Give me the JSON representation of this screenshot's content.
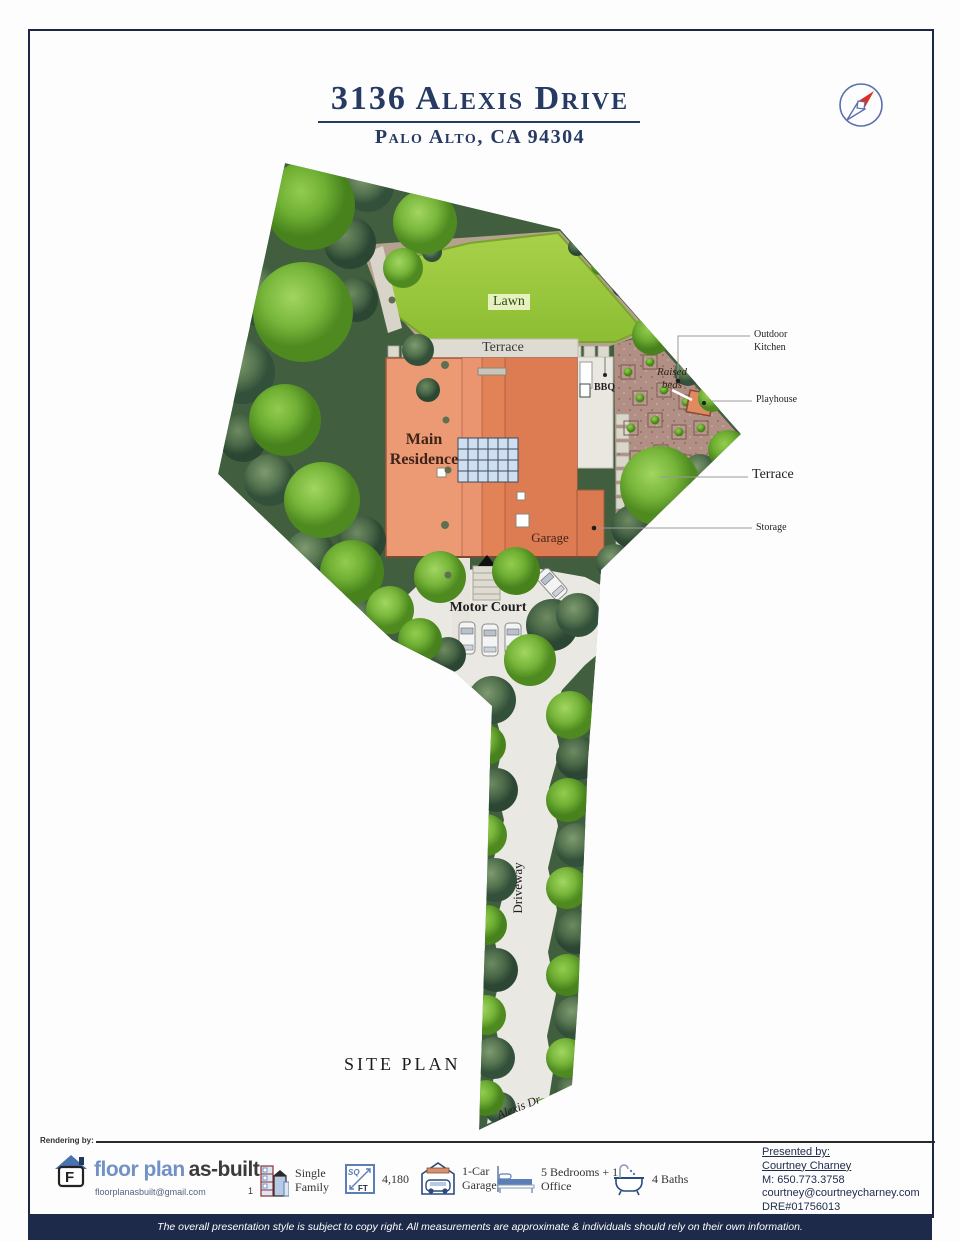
{
  "header": {
    "title": "3136 Alexis Drive",
    "subtitle": "Palo Alto, CA 94304"
  },
  "plan": {
    "site_plan_title": "SITE PLAN",
    "labels": {
      "lawn": "Lawn",
      "terrace_top": "Terrace",
      "main_residence": "Main Residence",
      "garage": "Garage",
      "bbq": "BBQ",
      "raised_beds": "Raised beds",
      "motor_court": "Motor Court",
      "driveway": "Driveway",
      "alexis_dr": "Alexis Dr",
      "outdoor_kitchen": "Outdoor Kitchen",
      "playhouse": "Playhouse",
      "terrace_right": "Terrace",
      "storage": "Storage"
    }
  },
  "footer": {
    "rendering_by": "Rendering by:",
    "logo": {
      "brand_blue": "floor plan",
      "brand_dark": "as-built",
      "letter": "F",
      "email": "floorplanasbuilt@gmail.com"
    },
    "stats": [
      {
        "icon": "building-icon",
        "prefix": "1",
        "label": "Single Family"
      },
      {
        "icon": "sqft-icon",
        "sq": "SQ",
        "ft": "FT",
        "label": "4,180"
      },
      {
        "icon": "garage-icon",
        "label": "1-Car Garage"
      },
      {
        "icon": "bed-icon",
        "label": "5 Bedrooms + 1 Office"
      },
      {
        "icon": "bath-icon",
        "label": "4 Baths"
      }
    ],
    "presented": {
      "heading": "Presented by:",
      "name": "Courtney Charney",
      "mobile": "M: 650.773.3758",
      "email": "courtney@courtneycharney.com",
      "dre": "DRE#01756013"
    },
    "disclaimer": "The overall presentation style is subject to copy right. All measurements are approximate & individuals should rely on their own information."
  },
  "colors": {
    "navy": "#1e2a4a",
    "house_orange": "#e78c63",
    "lawn_green": "#9cc83e",
    "compass_red": "#d93025"
  }
}
